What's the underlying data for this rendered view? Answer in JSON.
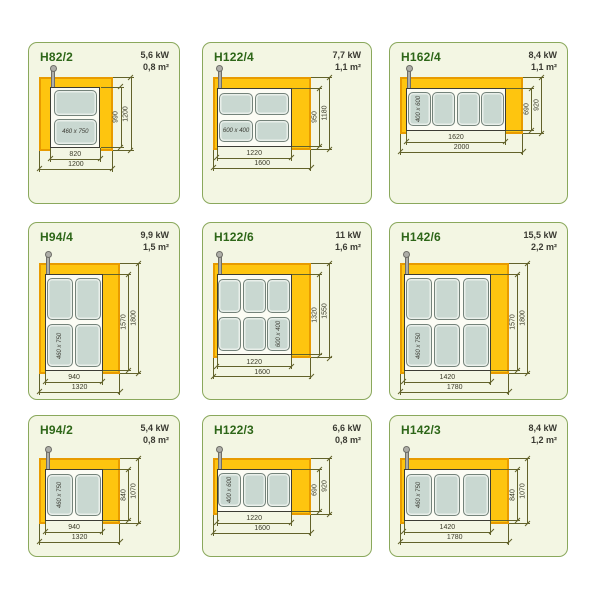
{
  "colors": {
    "panel_bg": "#f3f6e3",
    "panel_border": "#8aa85c",
    "title": "#2d6618",
    "spec_text": "#3a3a32",
    "yellow": "#fec50f",
    "yellow_border": "#e89b00",
    "surface_bg": "#fcfcf4",
    "surface_border": "#3c3c34",
    "plate_fill": "#c9d8d1",
    "plate_border": "#74837a",
    "pipe": "#aeaea8",
    "pipe_border": "#6e6e68",
    "dim_line": "#62622a",
    "dim_text": "#3a3a28"
  },
  "cells": [
    {
      "model": "H82/2",
      "power": "5,6 kW",
      "area": "0,8 m²",
      "diagram": {
        "outer_mm": [
          1200,
          1200
        ],
        "inner_mm": [
          820,
          990
        ],
        "inner_left_mm": 180,
        "plates": {
          "cols": 1,
          "rows": 2,
          "plate_mm": [
            750,
            460
          ],
          "label": "460 x 750",
          "label_index": 1,
          "label_rotated": false
        },
        "dims": {
          "inner_width": "820",
          "outer_width": "1200",
          "inner_height": "990",
          "outer_height": "1200"
        }
      }
    },
    {
      "model": "H122/4",
      "power": "7,7 kW",
      "area": "1,1 m²",
      "diagram": {
        "outer_mm": [
          1600,
          1180
        ],
        "inner_mm": [
          1220,
          950
        ],
        "inner_left_mm": 60,
        "plates": {
          "cols": 2,
          "rows": 2,
          "plate_mm": [
            600,
            400
          ],
          "label": "600 x 400",
          "label_index": 2,
          "label_rotated": false
        },
        "dims": {
          "inner_width": "1220",
          "outer_width": "1600",
          "inner_height": "950",
          "outer_height": "1180"
        }
      }
    },
    {
      "model": "H162/4",
      "power": "8,4 kW",
      "area": "1,1 m²",
      "diagram": {
        "outer_mm": [
          2000,
          920
        ],
        "inner_mm": [
          1620,
          690
        ],
        "inner_left_mm": 100,
        "plates": {
          "cols": 4,
          "rows": 1,
          "plate_mm": [
            400,
            600
          ],
          "label": "400 x 600",
          "label_index": 0,
          "label_rotated": true
        },
        "dims": {
          "inner_width": "1620",
          "outer_width": "2000",
          "inner_height": "690",
          "outer_height": "920"
        }
      }
    },
    {
      "model": "H94/4",
      "power": "9,9 kW",
      "area": "1,5 m²",
      "diagram": {
        "outer_mm": [
          1320,
          1800
        ],
        "inner_mm": [
          940,
          1570
        ],
        "inner_left_mm": 100,
        "plates": {
          "cols": 2,
          "rows": 2,
          "plate_mm": [
            460,
            750
          ],
          "label": "460 x 750",
          "label_index": 2,
          "label_rotated": true
        },
        "dims": {
          "inner_width": "940",
          "outer_width": "1320",
          "inner_height": "1570",
          "outer_height": "1800"
        }
      }
    },
    {
      "model": "H122/6",
      "power": "11 kW",
      "area": "1,6 m²",
      "diagram": {
        "outer_mm": [
          1600,
          1550
        ],
        "inner_mm": [
          1220,
          1320
        ],
        "inner_left_mm": 60,
        "plates": {
          "cols": 3,
          "rows": 2,
          "plate_mm": [
            400,
            600
          ],
          "label": "600 x 400",
          "label_index": 5,
          "label_rotated": true
        },
        "dims": {
          "inner_width": "1220",
          "outer_width": "1600",
          "inner_height": "1320",
          "outer_height": "1550"
        }
      }
    },
    {
      "model": "H142/6",
      "power": "15,5 kW",
      "area": "2,2 m²",
      "diagram": {
        "outer_mm": [
          1780,
          1800
        ],
        "inner_mm": [
          1420,
          1570
        ],
        "inner_left_mm": 60,
        "plates": {
          "cols": 3,
          "rows": 2,
          "plate_mm": [
            460,
            750
          ],
          "label": "460 x 750",
          "label_index": 3,
          "label_rotated": true
        },
        "dims": {
          "inner_width": "1420",
          "outer_width": "1780",
          "inner_height": "1570",
          "outer_height": "1800"
        }
      }
    },
    {
      "model": "H94/2",
      "power": "5,4 kW",
      "area": "0,8 m²",
      "diagram": {
        "outer_mm": [
          1320,
          1070
        ],
        "inner_mm": [
          940,
          840
        ],
        "inner_left_mm": 100,
        "plates": {
          "cols": 2,
          "rows": 1,
          "plate_mm": [
            460,
            750
          ],
          "label": "460 x 750",
          "label_index": 0,
          "label_rotated": true
        },
        "dims": {
          "inner_width": "940",
          "outer_width": "1320",
          "inner_height": "840",
          "outer_height": "1070"
        }
      }
    },
    {
      "model": "H122/3",
      "power": "6,6 kW",
      "area": "0,8 m²",
      "diagram": {
        "outer_mm": [
          1600,
          920
        ],
        "inner_mm": [
          1220,
          690
        ],
        "inner_left_mm": 60,
        "plates": {
          "cols": 3,
          "rows": 1,
          "plate_mm": [
            400,
            600
          ],
          "label": "400 x 600",
          "label_index": 0,
          "label_rotated": true
        },
        "dims": {
          "inner_width": "1220",
          "outer_width": "1600",
          "inner_height": "690",
          "outer_height": "920"
        }
      }
    },
    {
      "model": "H142/3",
      "power": "8,4 kW",
      "area": "1,2 m²",
      "diagram": {
        "outer_mm": [
          1780,
          1070
        ],
        "inner_mm": [
          1420,
          840
        ],
        "inner_left_mm": 60,
        "plates": {
          "cols": 3,
          "rows": 1,
          "plate_mm": [
            460,
            750
          ],
          "label": "460 x 750",
          "label_index": 0,
          "label_rotated": true
        },
        "dims": {
          "inner_width": "1420",
          "outer_width": "1780",
          "inner_height": "840",
          "outer_height": "1070"
        }
      }
    }
  ]
}
